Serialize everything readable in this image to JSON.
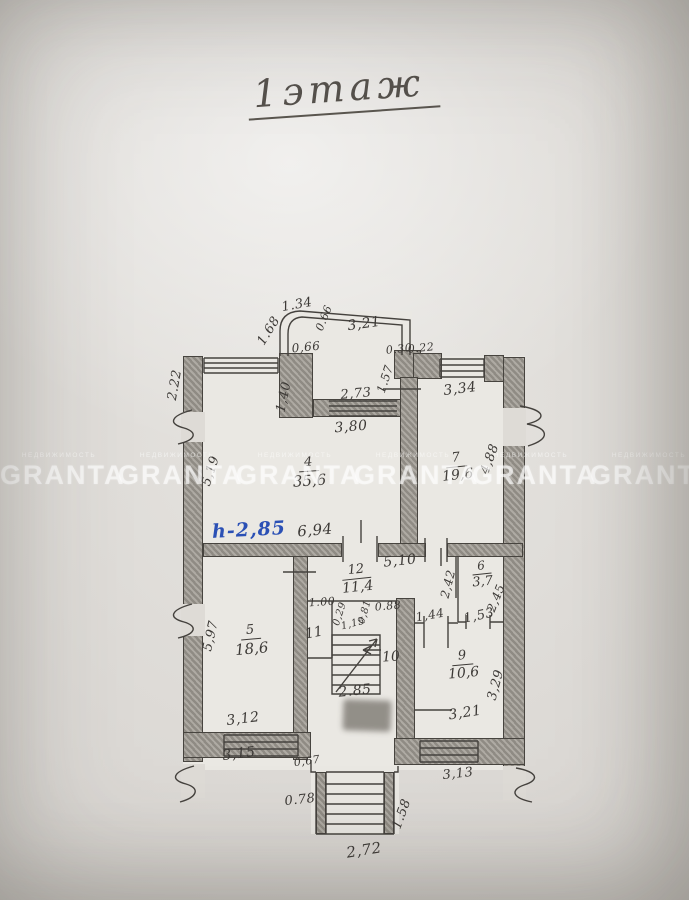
{
  "title": {
    "text": "1этаж"
  },
  "watermark": {
    "brand": "GRANTA",
    "sub": "НЕДВИЖИМОСТЬ",
    "repeat": 6
  },
  "annotations": {
    "ceiling_height_note": {
      "text": "h-2,85",
      "color": "#2b50b5"
    }
  },
  "plan": {
    "rooms": [
      {
        "id": "4",
        "number": "4",
        "area": "35,6"
      },
      {
        "id": "7",
        "number": "7",
        "area": "19,6"
      },
      {
        "id": "12",
        "number": "12",
        "area": "11,4"
      },
      {
        "id": "6",
        "number": "6",
        "area": "3,7"
      },
      {
        "id": "5",
        "number": "5",
        "area": "18,6"
      },
      {
        "id": "9",
        "number": "9",
        "area": "10,6"
      },
      {
        "id": "11",
        "number": "11",
        "area": ""
      },
      {
        "id": "10",
        "number": "10",
        "area": ""
      }
    ],
    "dimensions": [
      {
        "id": "d168",
        "text": "1.68"
      },
      {
        "id": "d134",
        "text": "1.34"
      },
      {
        "id": "d066a",
        "text": "0.66"
      },
      {
        "id": "d321",
        "text": "3,21"
      },
      {
        "id": "d066b",
        "text": "0,66"
      },
      {
        "id": "d030",
        "text": "0.30"
      },
      {
        "id": "d022",
        "text": "0.22"
      },
      {
        "id": "d157",
        "text": "1.57"
      },
      {
        "id": "d334",
        "text": "3,34"
      },
      {
        "id": "d273",
        "text": "2,73"
      },
      {
        "id": "d380",
        "text": "3,80"
      },
      {
        "id": "d140",
        "text": "1,40"
      },
      {
        "id": "d222",
        "text": "2.22"
      },
      {
        "id": "d519",
        "text": "5,19"
      },
      {
        "id": "d488",
        "text": "4,88"
      },
      {
        "id": "d694",
        "text": "6,94"
      },
      {
        "id": "d510",
        "text": "5,10"
      },
      {
        "id": "d242",
        "text": "2,42"
      },
      {
        "id": "d245",
        "text": "2,45"
      },
      {
        "id": "d153",
        "text": "1,53"
      },
      {
        "id": "d144",
        "text": "1,44"
      },
      {
        "id": "d100",
        "text": "1.00"
      },
      {
        "id": "d029",
        "text": "0,29"
      },
      {
        "id": "d115",
        "text": "1,15"
      },
      {
        "id": "d081",
        "text": "0,81"
      },
      {
        "id": "d088",
        "text": "0.88"
      },
      {
        "id": "d285",
        "text": "2.85"
      },
      {
        "id": "d597",
        "text": "5,97"
      },
      {
        "id": "d312",
        "text": "3,12"
      },
      {
        "id": "d315",
        "text": "3,15"
      },
      {
        "id": "d329",
        "text": "3,29"
      },
      {
        "id": "d321b",
        "text": "3,21"
      },
      {
        "id": "d313",
        "text": "3,13"
      },
      {
        "id": "d067",
        "text": "0,67"
      },
      {
        "id": "d078",
        "text": "0.78"
      },
      {
        "id": "d272",
        "text": "2,72"
      },
      {
        "id": "d158",
        "text": "1.58"
      }
    ]
  }
}
